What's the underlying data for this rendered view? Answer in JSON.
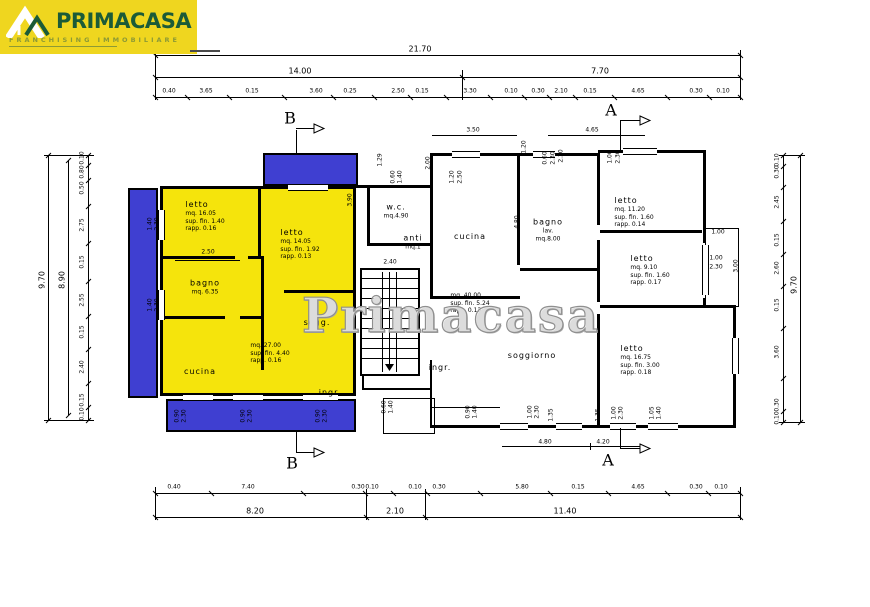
{
  "logo": {
    "brand": "PRIMACASA",
    "tagline": "FRANCHISING IMMOBILIARE",
    "bg_color": "#EFD61F",
    "brand_color": "#1B5B38",
    "tagline_color": "#8D9A35"
  },
  "watermark": "Primacasa",
  "colors": {
    "apartment_highlight": "#F5E40C",
    "balcony": "#3F3FD1",
    "line": "#000000"
  },
  "sections": {
    "a": "A",
    "b": "B"
  },
  "rooms": [
    {
      "name": "room-letto-1",
      "x": 205,
      "y": 216,
      "align": "left",
      "first_big": true,
      "lines": [
        "letto",
        "mq. 16.05",
        "sup. fin. 1.40",
        "rapp. 0.16"
      ]
    },
    {
      "name": "room-letto-2",
      "x": 300,
      "y": 244,
      "align": "left",
      "first_big": true,
      "lines": [
        "letto",
        "mq. 14.05",
        "sup. fin. 1.92",
        "rapp. 0.13"
      ]
    },
    {
      "name": "room-bagno-left",
      "x": 205,
      "y": 287,
      "first_big": true,
      "lines": [
        "bagno",
        "mq. 6.35"
      ]
    },
    {
      "name": "room-cucina-left",
      "x": 200,
      "y": 372,
      "first_big": true,
      "lines": [
        "cucina"
      ]
    },
    {
      "name": "left-apartment-stats",
      "x": 270,
      "y": 353,
      "align": "left",
      "lines": [
        "mq. 27.00",
        "sup. fin. 4.40",
        "rapp. 0.16"
      ]
    },
    {
      "name": "room-sogg",
      "x": 317,
      "y": 323,
      "first_big": true,
      "lines": [
        "sogg."
      ]
    },
    {
      "name": "room-ingr-left",
      "x": 330,
      "y": 393,
      "first_big": true,
      "lines": [
        "ingr."
      ]
    },
    {
      "name": "room-wc",
      "x": 396,
      "y": 211,
      "first_big": true,
      "lines": [
        "w.c.",
        "mq.4.90"
      ]
    },
    {
      "name": "room-anti",
      "x": 413,
      "y": 242,
      "first_big": true,
      "lines": [
        "anti",
        "mq.1"
      ]
    },
    {
      "name": "room-cucina-center",
      "x": 470,
      "y": 237,
      "first_big": true,
      "lines": [
        "cucina"
      ]
    },
    {
      "name": "center-apartment-stats",
      "x": 470,
      "y": 303,
      "align": "left",
      "lines": [
        "mq. 40.00",
        "sup. fin. 5.24",
        "rapp. 0.13"
      ]
    },
    {
      "name": "room-bagno-lav",
      "x": 548,
      "y": 230,
      "first_big": true,
      "lines": [
        "bagno",
        "lav.",
        "mq.8.00"
      ]
    },
    {
      "name": "room-ingr-center",
      "x": 440,
      "y": 368,
      "first_big": true,
      "lines": [
        "ingr."
      ]
    },
    {
      "name": "room-soggiorno",
      "x": 532,
      "y": 356,
      "first_big": true,
      "lines": [
        "soggiorno"
      ]
    },
    {
      "name": "room-letto-r1",
      "x": 634,
      "y": 212,
      "align": "left",
      "first_big": true,
      "lines": [
        "letto",
        "mq. 11.20",
        "sup. fin. 1.60",
        "rapp. 0.14"
      ]
    },
    {
      "name": "room-letto-r2",
      "x": 650,
      "y": 270,
      "align": "left",
      "first_big": true,
      "lines": [
        "letto",
        "mq. 9.10",
        "sup. fin. 1.60",
        "rapp. 0.17"
      ]
    },
    {
      "name": "room-letto-r3",
      "x": 640,
      "y": 360,
      "align": "left",
      "first_big": true,
      "lines": [
        "letto",
        "mq. 16.75",
        "sup. fin. 3.00",
        "rapp. 0.18"
      ]
    }
  ],
  "dim_rows": [
    {
      "name": "dim-top-overall",
      "o": "h",
      "y": 55,
      "x1": 155,
      "x2": 740,
      "size": 8,
      "mids": false,
      "labels": [
        {
          "t": "21.70",
          "x": 420
        }
      ]
    },
    {
      "name": "dim-top-groups",
      "o": "h",
      "y": 77,
      "x1": 155,
      "x2": 740,
      "size": 8,
      "mids": false,
      "split": [
        462
      ],
      "labels": [
        {
          "t": "14.00",
          "x": 300
        },
        {
          "t": "7.70",
          "x": 600
        }
      ]
    },
    {
      "name": "dim-top-details",
      "o": "h",
      "y": 97,
      "x1": 155,
      "x2": 740,
      "size": 6,
      "mids": true,
      "labels": [
        {
          "t": "0.40",
          "x": 169
        },
        {
          "t": "3.65",
          "x": 206
        },
        {
          "t": "0.15",
          "x": 252
        },
        {
          "t": "3.60",
          "x": 316
        },
        {
          "t": "0.25",
          "x": 350
        },
        {
          "t": "2.50",
          "x": 398
        },
        {
          "t": "0.15",
          "x": 422
        },
        {
          "t": "3.30",
          "x": 470
        },
        {
          "t": "0.10",
          "x": 511
        },
        {
          "t": "0.30",
          "x": 538
        },
        {
          "t": "2.10",
          "x": 561
        },
        {
          "t": "0.15",
          "x": 590
        },
        {
          "t": "4.65",
          "x": 638
        },
        {
          "t": "0.30",
          "x": 696
        },
        {
          "t": "0.10",
          "x": 723
        }
      ]
    },
    {
      "name": "dim-bottom-details",
      "o": "h",
      "y": 493,
      "x1": 155,
      "x2": 740,
      "size": 6,
      "mids": true,
      "labels": [
        {
          "t": "0.40",
          "x": 174
        },
        {
          "t": "7.40",
          "x": 248
        },
        {
          "t": "0.30",
          "x": 358
        },
        {
          "t": "0.10",
          "x": 372
        },
        {
          "t": "0.10",
          "x": 415
        },
        {
          "t": "0.30",
          "x": 439
        },
        {
          "t": "5.80",
          "x": 522
        },
        {
          "t": "0.15",
          "x": 578
        },
        {
          "t": "4.65",
          "x": 638
        },
        {
          "t": "0.30",
          "x": 696
        },
        {
          "t": "0.10",
          "x": 721
        }
      ]
    },
    {
      "name": "dim-bottom-groups",
      "o": "h",
      "y": 517,
      "x1": 155,
      "x2": 740,
      "size": 8,
      "mids": false,
      "split": [
        366,
        425
      ],
      "labels": [
        {
          "t": "8.20",
          "x": 255
        },
        {
          "t": "2.10",
          "x": 395
        },
        {
          "t": "11.40",
          "x": 565
        }
      ]
    },
    {
      "name": "dim-left-overall",
      "o": "v",
      "x": 48,
      "y1": 155,
      "y2": 420,
      "size": 8,
      "mids": false,
      "labels": [
        {
          "t": "9.70",
          "y": 280
        }
      ]
    },
    {
      "name": "dim-left-inner",
      "o": "v",
      "x": 68,
      "y1": 160,
      "y2": 415,
      "size": 8,
      "mids": false,
      "labels": [
        {
          "t": "8.90",
          "y": 280
        }
      ]
    },
    {
      "name": "dim-left-details",
      "o": "v",
      "x": 88,
      "y1": 155,
      "y2": 420,
      "size": 6,
      "mids": true,
      "labels": [
        {
          "t": "0.10",
          "y": 158
        },
        {
          "t": "0.80",
          "y": 172
        },
        {
          "t": "0.50",
          "y": 188
        },
        {
          "t": "2.75",
          "y": 225
        },
        {
          "t": "0.15",
          "y": 262
        },
        {
          "t": "2.55",
          "y": 300
        },
        {
          "t": "0.15",
          "y": 332
        },
        {
          "t": "2.40",
          "y": 367
        },
        {
          "t": "0.15",
          "y": 400
        },
        {
          "t": "0.10",
          "y": 414
        }
      ]
    },
    {
      "name": "dim-right-details",
      "o": "v",
      "x": 783,
      "y1": 155,
      "y2": 422,
      "size": 6,
      "mids": true,
      "labels": [
        {
          "t": "0.10",
          "y": 160
        },
        {
          "t": "0.30",
          "y": 172
        },
        {
          "t": "2.45",
          "y": 202
        },
        {
          "t": "0.15",
          "y": 240
        },
        {
          "t": "2.60",
          "y": 268
        },
        {
          "t": "0.15",
          "y": 305
        },
        {
          "t": "3.60",
          "y": 352
        },
        {
          "t": "0.30",
          "y": 405
        },
        {
          "t": "0.10",
          "y": 418
        }
      ]
    },
    {
      "name": "dim-right-overall",
      "o": "v",
      "x": 800,
      "y1": 155,
      "y2": 422,
      "size": 8,
      "mids": false,
      "labels": [
        {
          "t": "9.70",
          "y": 285
        }
      ]
    }
  ],
  "inline_dims": [
    {
      "t": "2.50",
      "x": 208,
      "y": 252,
      "rot": 0
    },
    {
      "t": "3.90",
      "x": 350,
      "y": 200,
      "rot": 1
    },
    {
      "t": "2.40",
      "x": 390,
      "y": 262,
      "rot": 0
    },
    {
      "t": "3.50",
      "x": 473,
      "y": 130,
      "rot": 0
    },
    {
      "t": "4.65",
      "x": 592,
      "y": 130,
      "rot": 0
    },
    {
      "t": "1.29",
      "x": 380,
      "y": 160,
      "rot": 1
    },
    {
      "t": "2.00",
      "x": 428,
      "y": 163,
      "rot": 1
    },
    {
      "t": "1.20",
      "x": 524,
      "y": 147,
      "rot": 1
    },
    {
      "t": "0.60",
      "x": 545,
      "y": 158,
      "rot": 1
    },
    {
      "t": "2.30",
      "x": 553,
      "y": 158,
      "rot": 1
    },
    {
      "t": "1.20",
      "x": 452,
      "y": 177,
      "rot": 1
    },
    {
      "t": "2.50",
      "x": 460,
      "y": 177,
      "rot": 1
    },
    {
      "t": "0.60",
      "x": 393,
      "y": 177,
      "rot": 1
    },
    {
      "t": "1.40",
      "x": 400,
      "y": 177,
      "rot": 1
    },
    {
      "t": "4.80",
      "x": 517,
      "y": 222,
      "rot": 1
    },
    {
      "t": "2.30",
      "x": 561,
      "y": 156,
      "rot": 1
    },
    {
      "t": "1.00",
      "x": 610,
      "y": 157,
      "rot": 1
    },
    {
      "t": "2.30",
      "x": 618,
      "y": 157,
      "rot": 1
    },
    {
      "t": "1.00",
      "x": 718,
      "y": 232,
      "rot": 0
    },
    {
      "t": "1.00",
      "x": 716,
      "y": 258,
      "rot": 0
    },
    {
      "t": "2.30",
      "x": 716,
      "y": 267,
      "rot": 0
    },
    {
      "t": "3.00",
      "x": 736,
      "y": 266,
      "rot": 1
    },
    {
      "t": "1.40",
      "x": 150,
      "y": 224,
      "rot": 1
    },
    {
      "t": "2.30",
      "x": 157,
      "y": 224,
      "rot": 1
    },
    {
      "t": "1.40",
      "x": 150,
      "y": 305,
      "rot": 1
    },
    {
      "t": "2.30",
      "x": 157,
      "y": 305,
      "rot": 1
    },
    {
      "t": "0.90",
      "x": 177,
      "y": 416,
      "rot": 1
    },
    {
      "t": "2.30",
      "x": 184,
      "y": 416,
      "rot": 1
    },
    {
      "t": "0.90",
      "x": 243,
      "y": 416,
      "rot": 1
    },
    {
      "t": "2.30",
      "x": 250,
      "y": 416,
      "rot": 1
    },
    {
      "t": "0.90",
      "x": 318,
      "y": 416,
      "rot": 1
    },
    {
      "t": "2.30",
      "x": 325,
      "y": 416,
      "rot": 1
    },
    {
      "t": "0.60",
      "x": 384,
      "y": 407,
      "rot": 1
    },
    {
      "t": "1.40",
      "x": 391,
      "y": 407,
      "rot": 1
    },
    {
      "t": "0.90",
      "x": 468,
      "y": 412,
      "rot": 1
    },
    {
      "t": "1.40",
      "x": 475,
      "y": 412,
      "rot": 1
    },
    {
      "t": "1.00",
      "x": 530,
      "y": 412,
      "rot": 1
    },
    {
      "t": "2.30",
      "x": 537,
      "y": 412,
      "rot": 1
    },
    {
      "t": "1.35",
      "x": 551,
      "y": 415,
      "rot": 1
    },
    {
      "t": "1.35",
      "x": 598,
      "y": 415,
      "rot": 1
    },
    {
      "t": "1.00",
      "x": 614,
      "y": 413,
      "rot": 1
    },
    {
      "t": "2.30",
      "x": 621,
      "y": 413,
      "rot": 1
    },
    {
      "t": "1.05",
      "x": 652,
      "y": 413,
      "rot": 1
    },
    {
      "t": "1.40",
      "x": 659,
      "y": 413,
      "rot": 1
    },
    {
      "t": "4.80",
      "x": 545,
      "y": 442,
      "rot": 0
    },
    {
      "t": "4.20",
      "x": 603,
      "y": 442,
      "rot": 0
    }
  ]
}
